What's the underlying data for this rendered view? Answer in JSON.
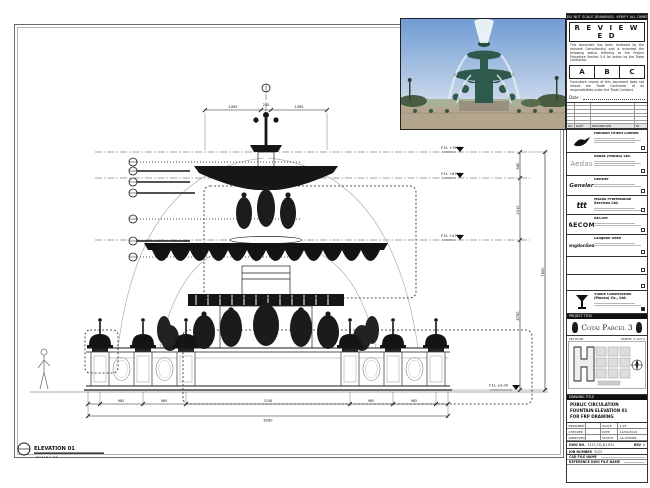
{
  "sheet": {
    "note_strip": "DO NOT SCALE DRAWINGS. VERIFY ALL DIMENSIONS ON SITE."
  },
  "stamp": {
    "title": "R E V I E W E D",
    "body1": "This document has been reviewed by the relevant Consultant(s) and is accorded the following status referring to the Project Procedure Section 5.4 for action by the Trade Contractor.",
    "grades": [
      "A",
      "B",
      "C"
    ],
    "body2": "Consultant review of this document does not relieve the Trade Contractor of its responsibilities under the Trade Contract.",
    "date_label": "Date :"
  },
  "revision_table": {
    "headers": [
      "NO.",
      "DATE",
      "DESCRIPTION",
      "BY"
    ]
  },
  "consultants": [
    {
      "logo_text": "",
      "name": "Handian Orient Limited"
    },
    {
      "logo_text": "Aedas",
      "name": "Aedas (Macau) Ltd."
    },
    {
      "logo_text": "Gensler",
      "name": "Gensler"
    },
    {
      "logo_text": "ttt",
      "name": "Macau Professional Services Ltd."
    },
    {
      "logo_text": "AECOM",
      "name": "AECOM"
    },
    {
      "logo_text": "LangdonSeah",
      "name": "Langdon Seah"
    },
    {
      "logo_text": "",
      "name": ""
    },
    {
      "logo_text": "",
      "name": ""
    },
    {
      "logo_text": "",
      "name": "Yiukie Construction (Macau) Co., Ltd."
    }
  ],
  "project": {
    "label": "PROJECT TITLE",
    "title": "Cotai Parcel 3"
  },
  "key_plan": {
    "label": "KEY PLAN",
    "zone": "PARCEL 3, LOT 2"
  },
  "title_block": {
    "drawing_title_label": "DRAWING TITLE",
    "title_line1": "PUBLIC CIRCULATION",
    "title_line2": "FOUNTAIN ELEVATION 01",
    "title_line3": "FOR FRP DRAWING",
    "designed_label": "DESIGNED",
    "designed": "-",
    "checked_label": "CHECKED",
    "checked": "-",
    "approved_label": "APPROVED",
    "approved": "-",
    "scale_label": "SCALE",
    "scale": "1:25",
    "date_label": "DATE",
    "date": "12/04/2019",
    "status_label": "STATUS",
    "status": "AS SHOWN",
    "dwg_no_label": "DWG NO.",
    "dwg_no": "3123_FD_B1-E01",
    "rev_label": "REV",
    "rev": "0",
    "job_label": "JOB NUMBER",
    "job": "3123",
    "cad_label": "CAD FILE NAME",
    "ref_label": "REFERENCE DWG FILE NAME"
  },
  "drawing": {
    "elevation_label": "ELEVATION 01",
    "scale_note": "SCALE 1:25",
    "levels": [
      "F.F.L +7600",
      "F.F.L +6760",
      "F.F.L +4750",
      "F.F.L ±0.00"
    ],
    "dims": {
      "top": [
        "1495",
        "240",
        "1495"
      ],
      "right": [
        "840",
        "2010",
        "4750"
      ],
      "right_total": "7600",
      "bottom": [
        "985",
        "985",
        "3740",
        "985",
        "985"
      ],
      "bottom_total": "8280"
    }
  }
}
